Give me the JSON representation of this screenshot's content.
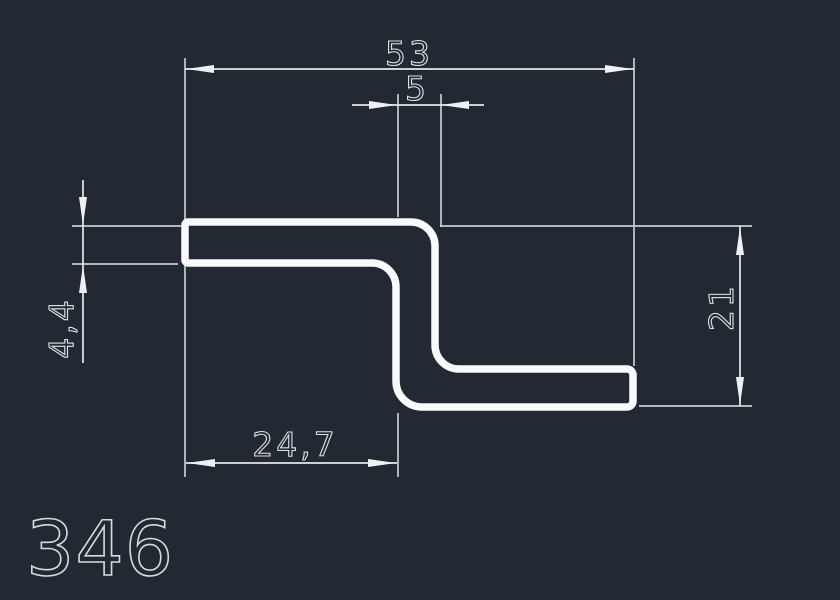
{
  "colors": {
    "background": "#232933",
    "extension_line": "#c6ccd4",
    "dimension_line": "#e4e8ec",
    "profile_stroke": "#f8fafb",
    "text": "#dde1e6"
  },
  "profile": {
    "number": "346",
    "shape": "Z-profile cross-section"
  },
  "dimensions": {
    "overall_width": {
      "label": "53",
      "value": 53
    },
    "bend_width": {
      "label": "5",
      "value": 5
    },
    "wall_thickness": {
      "label": "4,4",
      "value": 4.4
    },
    "overall_height": {
      "label": "21",
      "value": 21
    },
    "lower_flange_width": {
      "label": "24,7",
      "value": 24.7
    }
  }
}
